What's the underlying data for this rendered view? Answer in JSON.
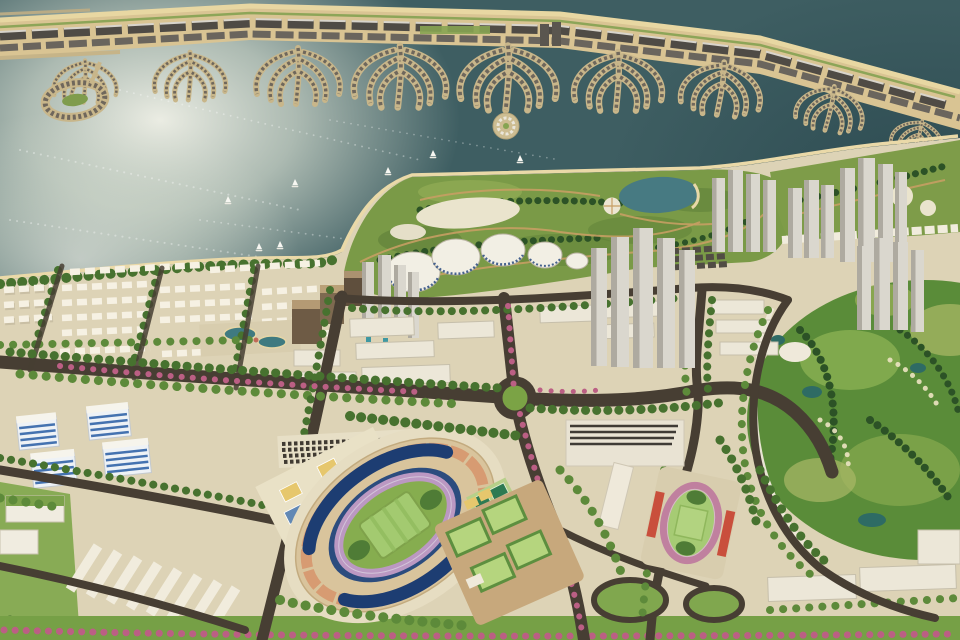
{
  "meta": {
    "type": "3d-aerial-masterplan-render",
    "description": "Aerial rendering of a coastal city masterplan: palm-frond barrier island and lagoon at top, central park with dome pavilions and lake, white high-rise tower clusters, stadium and sports complex, golf course at right, low-rise districts and flowering boulevards.",
    "image_size": "960x640"
  },
  "palette": {
    "sea": "#3e5e62",
    "sea_glint": "#f0f1e8",
    "sand": "#d9c493",
    "land": "#ddd3b6",
    "park_green": "#7a9a47",
    "golf_green": "#5a8c39",
    "road": "#473e33",
    "lake": "#477a82",
    "building_white": "#ece7d8",
    "tower_gray": "#dad7ce",
    "stadium_roof_blue": "#1d3d72",
    "stadium_track_mauve": "#bb98c2",
    "practice_track_pink": "#c0809f",
    "flower_pink": "#bb5f84",
    "court_yellow": "#e6c76d",
    "court_blue": "#6188b4",
    "tennis_green": "#2e7a52",
    "stand_red": "#c94f3c",
    "office_stripe_blue": "#4472b0",
    "tree_green": "#47722f"
  },
  "labels": {
    "scene": "Coastal city masterplan aerial render",
    "sea": "Sea with sun glint",
    "barrier_island": "Palm-frond barrier island strip",
    "lagoon": "Lagoon between island and mainland",
    "sailboats": "Sailboats on the water",
    "park": "Central park peninsula",
    "lake": "Park lake",
    "domes": "White dome pavilions",
    "towers": "High-rise tower clusters",
    "stadium": "Main stadium with blue roofs and running track",
    "practice_track": "Practice athletics track with red stands",
    "courts": "Multi-colored sports courts",
    "fields": "Practice pitches",
    "golf": "Golf course",
    "offices": "Blue-glass office buildings",
    "housing": "Low-rise housing rows",
    "warehouses": "Warehouse rows",
    "roundabout": "Roundabout",
    "boulevard": "Flowering boulevard medians"
  },
  "counts": {
    "sailboats": 8,
    "dome_pavilions": 5,
    "tower_clusters": 5,
    "practice_fields": 4,
    "striped_office_buildings": 4
  }
}
